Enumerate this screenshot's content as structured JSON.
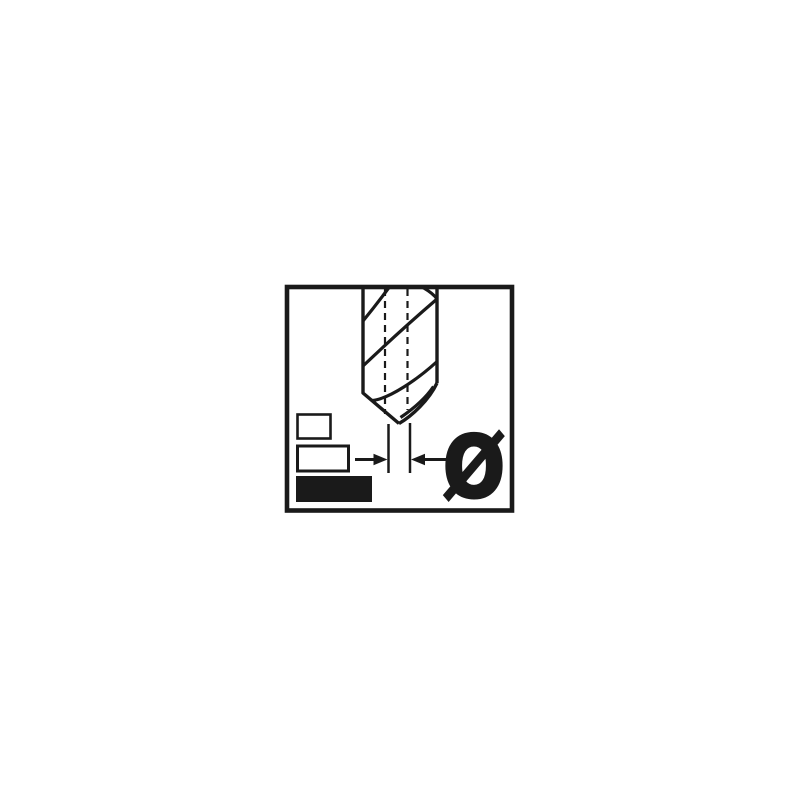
{
  "pictogram": {
    "diameter_symbol": "Ø",
    "colors": {
      "ink": "#1a1a1a",
      "background": "#ffffff"
    },
    "icons": {
      "drill_bit": "twist-drill-icon",
      "center_lines": "dashed-axis-lines",
      "dimension_arrows": "inward-pointing-arrows",
      "size_indicators": [
        "outline-bar-small",
        "outline-bar-medium",
        "filled-bar-large"
      ]
    }
  }
}
